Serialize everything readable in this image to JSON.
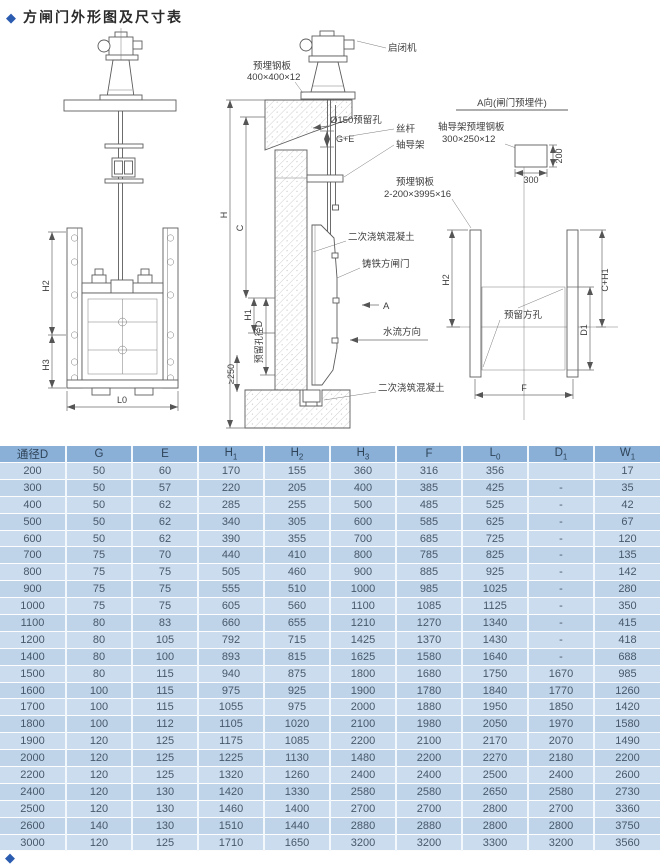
{
  "page": {
    "bullet": "◆",
    "title": "方闸门外形图及尺寸表"
  },
  "drawing": {
    "labels": {
      "hoist": "启闭机",
      "embed_plate": "预埋钢板",
      "embed_plate_size_top": "400×400×12",
      "hole_150": "Ø150预留孔",
      "g_plus_e": "G+E",
      "screw_rod": "丝杆",
      "shaft_guide": "轴导架",
      "secondary_concrete": "二次浇筑混凝土",
      "cast_iron_gate": "铸铁方闸门",
      "flow_direction": "水流方向",
      "section_mark": "A",
      "hole_diameter": "预留孔径D",
      "min_embed": "≥250",
      "a_view_title": "A向(闸门预埋件)",
      "guide_plate": "轴导架预埋钢板",
      "guide_plate_size": "300×250×12",
      "embed_plate_wall_size": "2-200×3995×16",
      "square_hole": "预留方孔",
      "dim_300": "300",
      "dim_200": "200"
    },
    "dims": {
      "h": "H",
      "c": "C",
      "h1": "H1",
      "h2": "H2",
      "h3": "H3",
      "l0": "L0",
      "c_h1": "C+H1",
      "d1": "D1",
      "f": "F"
    }
  },
  "table": {
    "headers": [
      {
        "base": "通径D",
        "sub": ""
      },
      {
        "base": "G",
        "sub": ""
      },
      {
        "base": "E",
        "sub": ""
      },
      {
        "base": "H",
        "sub": "1"
      },
      {
        "base": "H",
        "sub": "2"
      },
      {
        "base": "H",
        "sub": "3"
      },
      {
        "base": "F",
        "sub": ""
      },
      {
        "base": "L",
        "sub": "0"
      },
      {
        "base": "D",
        "sub": "1"
      },
      {
        "base": "W",
        "sub": "1"
      }
    ],
    "rows": [
      [
        "200",
        "50",
        "60",
        "170",
        "155",
        "360",
        "316",
        "356",
        "",
        "17"
      ],
      [
        "300",
        "50",
        "57",
        "220",
        "205",
        "400",
        "385",
        "425",
        "-",
        "35"
      ],
      [
        "400",
        "50",
        "62",
        "285",
        "255",
        "500",
        "485",
        "525",
        "-",
        "42"
      ],
      [
        "500",
        "50",
        "62",
        "340",
        "305",
        "600",
        "585",
        "625",
        "-",
        "67"
      ],
      [
        "600",
        "50",
        "62",
        "390",
        "355",
        "700",
        "685",
        "725",
        "-",
        "120"
      ],
      [
        "700",
        "75",
        "70",
        "440",
        "410",
        "800",
        "785",
        "825",
        "-",
        "135"
      ],
      [
        "800",
        "75",
        "75",
        "505",
        "460",
        "900",
        "885",
        "925",
        "-",
        "142"
      ],
      [
        "900",
        "75",
        "75",
        "555",
        "510",
        "1000",
        "985",
        "1025",
        "-",
        "280"
      ],
      [
        "1000",
        "75",
        "75",
        "605",
        "560",
        "1100",
        "1085",
        "1125",
        "-",
        "350"
      ],
      [
        "1100",
        "80",
        "83",
        "660",
        "655",
        "1210",
        "1270",
        "1340",
        "-",
        "415"
      ],
      [
        "1200",
        "80",
        "105",
        "792",
        "715",
        "1425",
        "1370",
        "1430",
        "-",
        "418"
      ],
      [
        "1400",
        "80",
        "100",
        "893",
        "815",
        "1625",
        "1580",
        "1640",
        "-",
        "688"
      ],
      [
        "1500",
        "80",
        "115",
        "940",
        "875",
        "1800",
        "1680",
        "1750",
        "1670",
        "985"
      ],
      [
        "1600",
        "100",
        "115",
        "975",
        "925",
        "1900",
        "1780",
        "1840",
        "1770",
        "1260"
      ],
      [
        "1700",
        "100",
        "115",
        "1055",
        "975",
        "2000",
        "1880",
        "1950",
        "1850",
        "1420"
      ],
      [
        "1800",
        "100",
        "112",
        "1105",
        "1020",
        "2100",
        "1980",
        "2050",
        "1970",
        "1580"
      ],
      [
        "1900",
        "120",
        "125",
        "1175",
        "1085",
        "2200",
        "2100",
        "2170",
        "2070",
        "1490"
      ],
      [
        "2000",
        "120",
        "125",
        "1225",
        "1130",
        "1480",
        "2200",
        "2270",
        "2180",
        "2200"
      ],
      [
        "2200",
        "120",
        "125",
        "1320",
        "1260",
        "2400",
        "2400",
        "2500",
        "2400",
        "2600"
      ],
      [
        "2400",
        "120",
        "130",
        "1420",
        "1330",
        "2580",
        "2580",
        "2650",
        "2580",
        "2730"
      ],
      [
        "2500",
        "120",
        "130",
        "1460",
        "1400",
        "2700",
        "2700",
        "2800",
        "2700",
        "3360"
      ],
      [
        "2600",
        "140",
        "130",
        "1510",
        "1440",
        "2880",
        "2880",
        "2800",
        "2800",
        "3750"
      ],
      [
        "3000",
        "120",
        "125",
        "1710",
        "1650",
        "3200",
        "3200",
        "3300",
        "3200",
        "3560"
      ]
    ]
  },
  "colors": {
    "accent_blue": "#2b5cb0",
    "table_header_bg": "#8ab0d8",
    "table_row_light": "#cbdcef",
    "table_row_dark": "#c0d4e9"
  }
}
